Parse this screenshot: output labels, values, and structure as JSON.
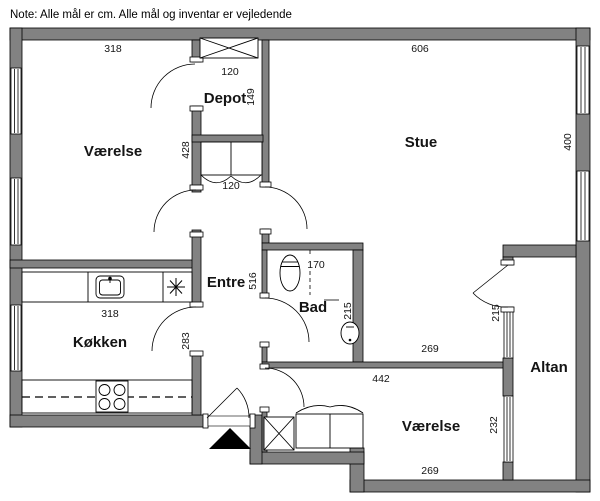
{
  "note": "Note: Alle mål er cm. Alle mål og inventar er vejledende",
  "colors": {
    "wall": "#828282",
    "outline": "#000000",
    "background": "#ffffff",
    "entrance_marker": "#000000"
  },
  "rooms": {
    "vaerelse_top_left": {
      "label": "Værelse",
      "width_cm": "318",
      "height_cm": "428"
    },
    "depot": {
      "label": "Depot",
      "width_cm": "120",
      "height_cm": "149"
    },
    "stue": {
      "label": "Stue",
      "width_cm": "606",
      "height_cm": "400"
    },
    "entre": {
      "label": "Entre",
      "length_cm": "516"
    },
    "bad": {
      "label": "Bad",
      "width_cm": "170",
      "height_cm": "215"
    },
    "koekken": {
      "label": "Køkken",
      "width_cm": "318",
      "height_cm": "283"
    },
    "vaerelse_bottom_right": {
      "label": "Værelse",
      "width_top_cm": "442",
      "height_cm": "232",
      "width_bottom_cm": "269"
    },
    "altan": {
      "label": "Altan",
      "door_cm": "215"
    },
    "passage": {
      "width_cm": "269"
    },
    "hall_cabinet": {
      "door_cm": "120"
    }
  },
  "fixtures": [
    "wardrobe-x-icon",
    "cabinet-double-door-icon",
    "kitchen-sink-icon",
    "cooktop-icon",
    "extractor-star-icon",
    "toilet-icon",
    "washbasin-icon",
    "window-icon",
    "door-swing-icon",
    "entrance-arrow-icon"
  ]
}
